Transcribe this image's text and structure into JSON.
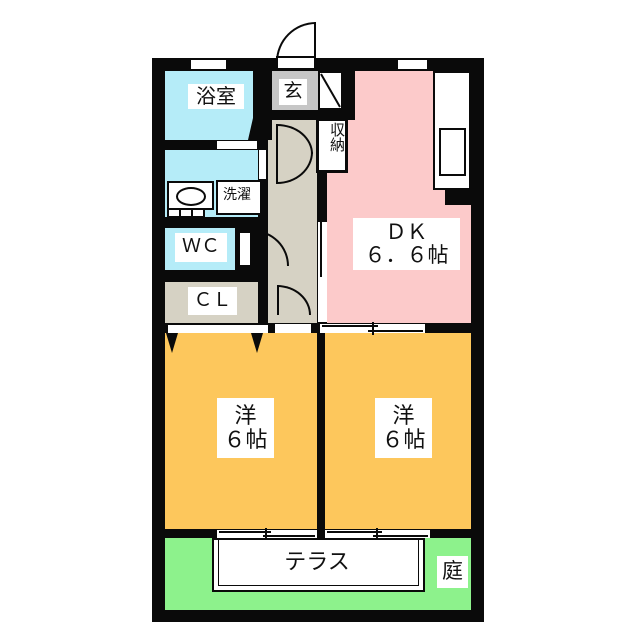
{
  "floorplan": {
    "title": "2DK apartment floor plan",
    "rooms": {
      "bath": {
        "label": "浴室"
      },
      "entrance": {
        "label": "玄"
      },
      "storage": {
        "label": "収納"
      },
      "laundry": {
        "label": "洗濯"
      },
      "wc": {
        "label": "ＷＣ"
      },
      "closet": {
        "label": "ＣＬ"
      },
      "dk": {
        "label": "ＤＫ",
        "area": "６．６帖"
      },
      "bedroom_left": {
        "label": "洋",
        "area": "６帖"
      },
      "bedroom_right": {
        "label": "洋",
        "area": "６帖"
      },
      "terrace": {
        "label": "テラス"
      },
      "garden": {
        "label": "庭"
      }
    },
    "palette": {
      "wall": "#0a0a0a",
      "water_blue": "#b5ecf8",
      "dk_pink": "#fccaca",
      "room_orange": "#fdc75c",
      "garden_green": "#8df28c",
      "entry_gray": "#c6c6c6",
      "hall_beige": "#d6d2c4",
      "label_bg": "#ffffff"
    }
  }
}
